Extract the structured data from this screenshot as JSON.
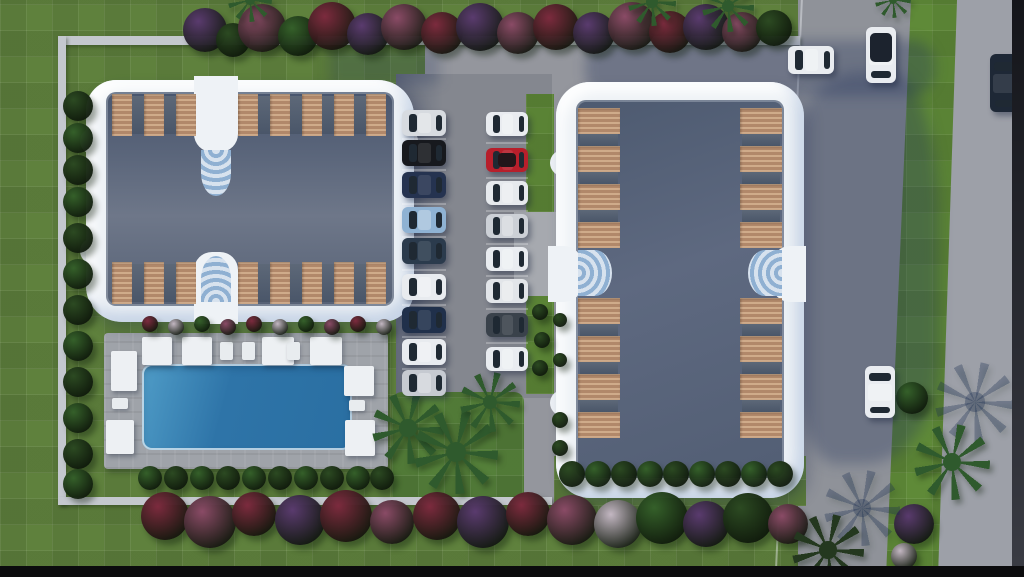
{
  "scene": {
    "type": "aerial-3d-architectural-render",
    "description": "Top-down rendering of a residential complex site plan: two apartment buildings with scalloped white rims and slate roofs, wooden balcony decks, a central parking area with two rows of cars, a swimming pool with white umbrellas and loungers, lawns, hedges, flowering shrubs, palm trees, and roads with cars along the right side"
  },
  "palette": {
    "lawn_green": "#5f813d",
    "bright_green": "#5f8a38",
    "road_gray": "#8f9299",
    "right_road_gray": "#9da0a8",
    "pavement_gray": "#94969d",
    "asphalt_gray": "#84878f",
    "wall_light": "#c4c8ce",
    "building_white": "#eef2f6",
    "roof_dark": "#49566e",
    "roof_light": "#6e7789",
    "wood_light": "#cfab8a",
    "wood_dark": "#b1886a",
    "divider_gray": "#525e71",
    "stair_blue": "#8fb0d2",
    "pool_blue": "#2e74a8",
    "pool_blue_light": "#4f9cc7",
    "deck_gray": "#9fa3a9",
    "umbrella_white": "#edf0f3",
    "hedge_dark": "#2c4a22",
    "hedge_green": "#35602a",
    "palm_green": "#2f5a2d",
    "palm_dark": "#24381f",
    "flower_crimson": "#7c2b3e",
    "flower_purple": "#5a3b6e",
    "flower_plum": "#8a4b66",
    "flower_white": "#c3b7c2",
    "shadow_blue": "rgba(33,50,90,0.32)",
    "glass_dark": "#1f2933",
    "black_bar": "#0b0b0d"
  },
  "buildings": [
    {
      "name": "west-building",
      "rim_color": "#eef2f6",
      "roof_colors": [
        "#49566e",
        "#6e7789"
      ],
      "balcony_wood": "#c9a585",
      "balcony_clusters": {
        "top": [
          3,
          5
        ],
        "bottom": [
          3,
          5
        ]
      },
      "stairwells": [
        "top-center",
        "bottom-center"
      ]
    },
    {
      "name": "east-building",
      "rim_color": "#eef2f6",
      "roof_colors": [
        "#4d5a70",
        "#5e6980"
      ],
      "balcony_wood": "#c9a585",
      "balcony_clusters": {
        "left": [
          4,
          4
        ],
        "right": [
          4,
          4
        ]
      },
      "stairwells": [
        "left-center",
        "right-center"
      ]
    }
  ],
  "pool": {
    "water_color": "#2e74a8",
    "deck_color": "#9fa3a9",
    "umbrella_color": "#edf0f3",
    "umbrella_count": 8,
    "lounger_count": 5
  },
  "parking": {
    "surface_color": "#84878f",
    "left_column_car_colors": [
      "#d7dbe0",
      "#17191e",
      "#253350",
      "#8fb2d3",
      "#2b3b4d",
      "#e8ebef",
      "#20304b",
      "#e8ebef",
      "#c6cad1"
    ],
    "right_column_car_colors": [
      "#e9ecf0",
      "#b71f2b",
      "#e6e9ed",
      "#ccd0d6",
      "#e9ecf0",
      "#e2e5e9",
      "#3a424b",
      "#e9ecf0"
    ]
  },
  "road": {
    "asphalt_color": "#8f9299",
    "east_lane_color": "#9da0a8",
    "median_color": "#5f8a38",
    "cars": [
      {
        "name": "parked-white-car",
        "color": "#e9ecf0"
      },
      {
        "name": "driving-white-car-dark-roof",
        "color": "#e9ecf0",
        "roof_color": "#1c232e"
      },
      {
        "name": "navy-car-east-lane",
        "color": "#1e2836"
      },
      {
        "name": "driving-white-car-south",
        "color": "#e9ecf0"
      }
    ]
  },
  "landscape": {
    "lawn_color": "#5f813d",
    "top_flowering_trees": 17,
    "left_hedge_trees": 12,
    "pool_hedge_bushes": 10,
    "east_building_hedge_bushes": 9,
    "south_flower_bushes": 15,
    "palm_trees": 9,
    "flower_colors": [
      "#7c2b3e",
      "#5a3b6e",
      "#8a4b66",
      "#c3b7c2"
    ]
  }
}
